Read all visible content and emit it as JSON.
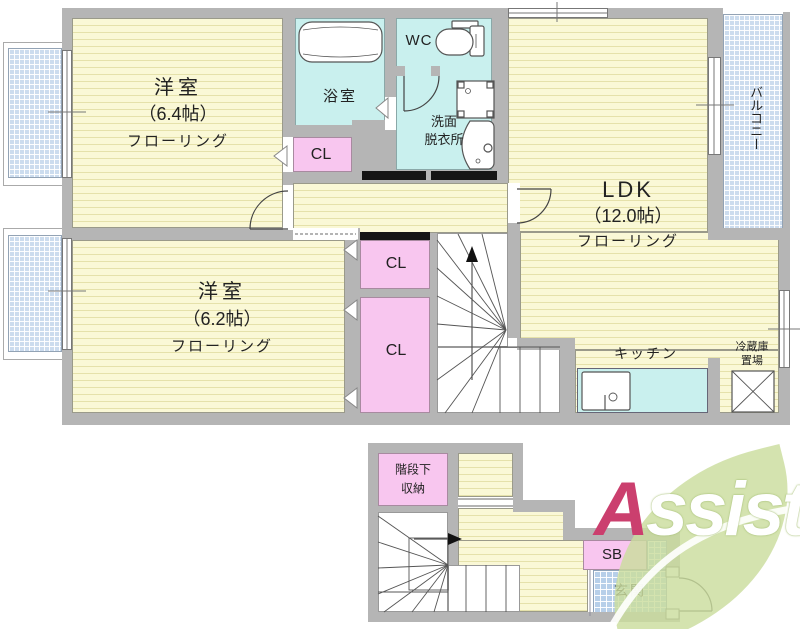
{
  "colors": {
    "wall_gray": "#b5b5b5",
    "room_yellow": "#faf8d6",
    "room_stripe": "#e5e1aa",
    "wet_area_cyan": "#c9f0ee",
    "closet_pink": "#f8c6ef",
    "balcony_blue": "#ccdcee",
    "entrance_blue": "#b7cfe9",
    "slide_door_black": "#151515",
    "logo_leaf_green": "#cbdd9e",
    "logo_a_red": "#cb3f6e"
  },
  "upper": {
    "bedroom1": {
      "name": "洋室",
      "size": "（6.4帖）",
      "floor": "フローリング"
    },
    "bedroom2": {
      "name": "洋室",
      "size": "（6.2帖）",
      "floor": "フローリング"
    },
    "ldk": {
      "name": "LDK",
      "size": "（12.0帖）",
      "floor": "フローリング"
    },
    "bathroom": {
      "label": "浴室"
    },
    "wc": {
      "label": "WC"
    },
    "washroom": {
      "line1": "洗面",
      "line2": "脱衣所"
    },
    "closet_bath": {
      "label": "CL"
    },
    "closet_upper": {
      "label": "CL"
    },
    "closet_lower": {
      "label": "CL"
    },
    "kitchen": {
      "label": "キッチン"
    },
    "fridge": {
      "line1": "冷蔵庫",
      "line2": "置場"
    },
    "balcony": {
      "label": "バルコニー"
    }
  },
  "lower": {
    "under_stair_storage": {
      "line1": "階段下",
      "line2": "収納"
    },
    "shoe_box": {
      "label": "SB"
    },
    "entrance": {
      "label": "玄関"
    }
  },
  "logo": {
    "a": "A",
    "rest": "ssist"
  }
}
